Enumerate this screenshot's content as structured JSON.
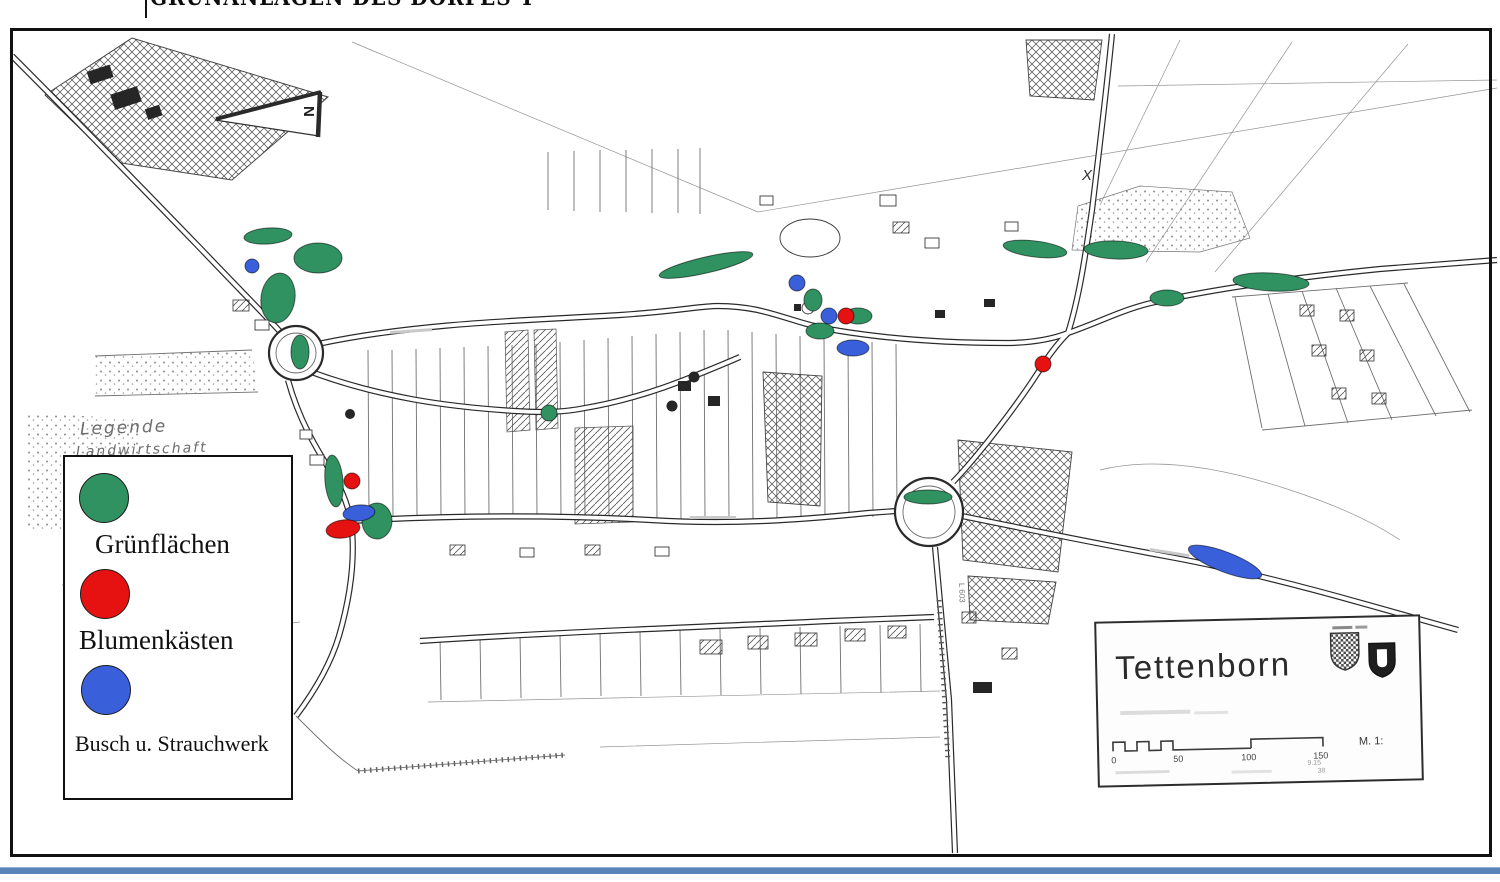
{
  "page": {
    "clipped_title_text": "GRÜNANLAGEN DES DORFES TETTENBORN"
  },
  "colors": {
    "green": "#2f9260",
    "red": "#e61111",
    "blue": "#3a5fdb",
    "bottom_rule": "#5b84ba"
  },
  "legend": {
    "heading_handwritten": "Legende",
    "background_word_partial": "Landwirtschaft",
    "items": [
      {
        "key": "gruenflaechen",
        "label": "Grünflächen",
        "color_key": "green"
      },
      {
        "key": "blumenkaesten",
        "label": "Blumenkästen",
        "color_key": "red"
      },
      {
        "key": "busch_strauchwerk",
        "label": "Busch u. Strauchwerk",
        "color_key": "blue"
      }
    ]
  },
  "north_arrow": {
    "letter": "N"
  },
  "map_annotations": {
    "field_mark": "X",
    "road_label": "L 603"
  },
  "title_box": {
    "place_name": "Tettenborn",
    "scale_ticks": [
      "0",
      "50",
      "100",
      "150"
    ],
    "scale_prefix": "M. 1:",
    "fine_print": [
      "9.15",
      "38"
    ]
  },
  "markers": [
    {
      "color_key": "green",
      "cx": 268,
      "cy": 236,
      "rx": 24,
      "ry": 8,
      "rot": -4
    },
    {
      "color_key": "green",
      "cx": 318,
      "cy": 258,
      "rx": 24,
      "ry": 15,
      "rot": 0
    },
    {
      "color_key": "green",
      "cx": 278,
      "cy": 298,
      "rx": 17,
      "ry": 25,
      "rot": 8
    },
    {
      "color_key": "green",
      "cx": 300,
      "cy": 352,
      "rx": 9,
      "ry": 17,
      "rot": 0
    },
    {
      "color_key": "green",
      "cx": 706,
      "cy": 265,
      "rx": 48,
      "ry": 8,
      "rot": -13
    },
    {
      "color_key": "green",
      "cx": 813,
      "cy": 300,
      "rx": 9,
      "ry": 11,
      "rot": 0
    },
    {
      "color_key": "green",
      "cx": 858,
      "cy": 316,
      "rx": 14,
      "ry": 8,
      "rot": 0
    },
    {
      "color_key": "green",
      "cx": 820,
      "cy": 331,
      "rx": 14,
      "ry": 8,
      "rot": 0
    },
    {
      "color_key": "green",
      "cx": 549,
      "cy": 413,
      "rx": 8,
      "ry": 8,
      "rot": 0
    },
    {
      "color_key": "green",
      "cx": 334,
      "cy": 481,
      "rx": 9,
      "ry": 26,
      "rot": -5
    },
    {
      "color_key": "green",
      "cx": 377,
      "cy": 521,
      "rx": 15,
      "ry": 18,
      "rot": 0
    },
    {
      "color_key": "green",
      "cx": 928,
      "cy": 497,
      "rx": 24,
      "ry": 7,
      "rot": 0
    },
    {
      "color_key": "green",
      "cx": 1035,
      "cy": 249,
      "rx": 32,
      "ry": 8,
      "rot": 7
    },
    {
      "color_key": "green",
      "cx": 1116,
      "cy": 250,
      "rx": 32,
      "ry": 9,
      "rot": 2
    },
    {
      "color_key": "green",
      "cx": 1167,
      "cy": 298,
      "rx": 17,
      "ry": 8,
      "rot": 0
    },
    {
      "color_key": "green",
      "cx": 1271,
      "cy": 282,
      "rx": 38,
      "ry": 9,
      "rot": 3
    },
    {
      "color_key": "blue",
      "cx": 252,
      "cy": 266,
      "rx": 7,
      "ry": 7,
      "rot": 0
    },
    {
      "color_key": "blue",
      "cx": 797,
      "cy": 283,
      "rx": 8,
      "ry": 8,
      "rot": 0
    },
    {
      "color_key": "blue",
      "cx": 829,
      "cy": 316,
      "rx": 8,
      "ry": 8,
      "rot": 0
    },
    {
      "color_key": "blue",
      "cx": 853,
      "cy": 348,
      "rx": 16,
      "ry": 8,
      "rot": 0
    },
    {
      "color_key": "blue",
      "cx": 359,
      "cy": 513,
      "rx": 16,
      "ry": 8,
      "rot": -6
    },
    {
      "color_key": "blue",
      "cx": 1225,
      "cy": 562,
      "rx": 39,
      "ry": 10,
      "rot": 21
    },
    {
      "color_key": "red",
      "cx": 846,
      "cy": 316,
      "rx": 8,
      "ry": 8,
      "rot": 0
    },
    {
      "color_key": "red",
      "cx": 1043,
      "cy": 364,
      "rx": 8,
      "ry": 8,
      "rot": 0
    },
    {
      "color_key": "red",
      "cx": 352,
      "cy": 481,
      "rx": 8,
      "ry": 8,
      "rot": 0
    },
    {
      "color_key": "red",
      "cx": 343,
      "cy": 529,
      "rx": 17,
      "ry": 9,
      "rot": -8
    }
  ]
}
